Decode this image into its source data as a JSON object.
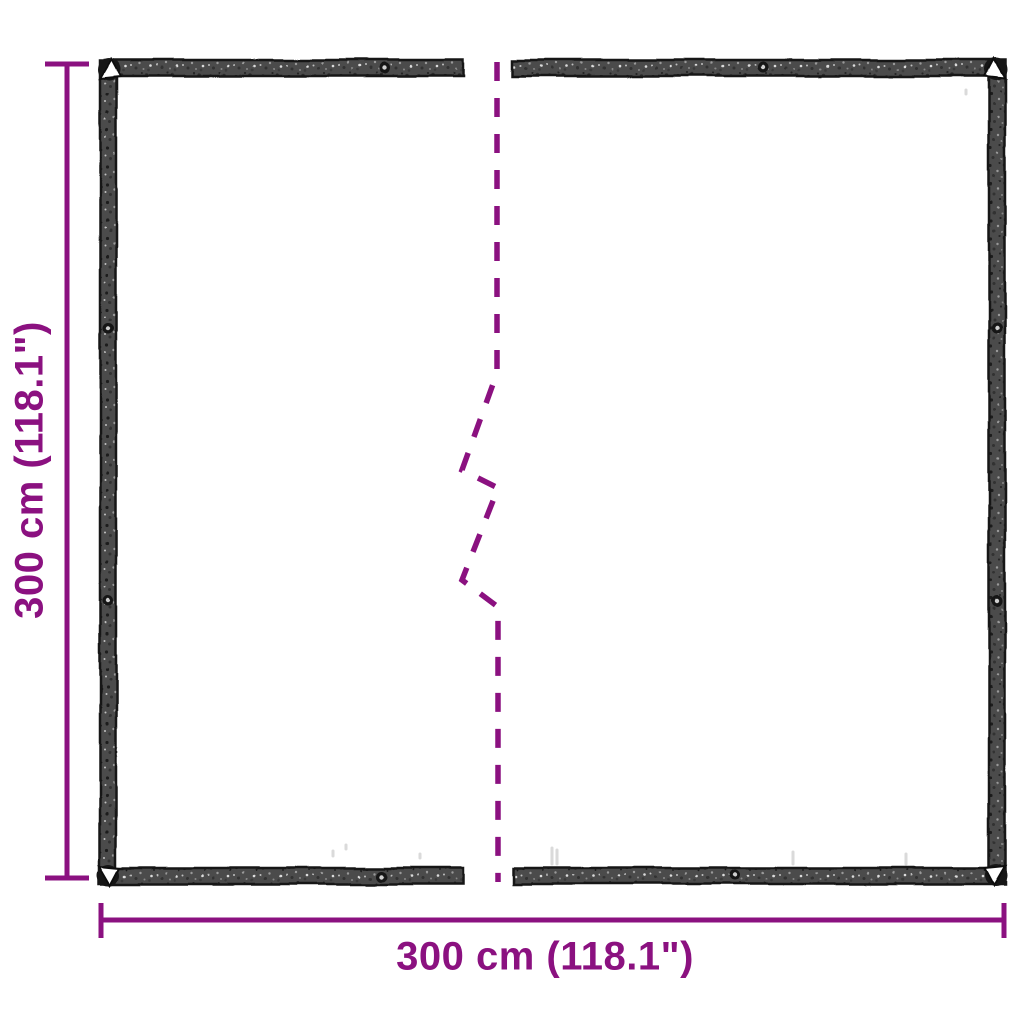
{
  "diagram": {
    "type": "product-dimension-diagram",
    "subject": "clear tarp with reinforced border and eyelets, shown split with a break line",
    "height_dimension": {
      "label": "300 cm (118.1\")",
      "value_cm": 300,
      "value_in": 118.1,
      "orientation": "vertical"
    },
    "width_dimension": {
      "label": "300 cm (118.1\")",
      "value_cm": 300,
      "value_in": 118.1,
      "orientation": "horizontal"
    },
    "colors": {
      "accent": "#8B1180",
      "tarp_band": "#4C4C4C",
      "background": "#FFFFFF"
    }
  }
}
